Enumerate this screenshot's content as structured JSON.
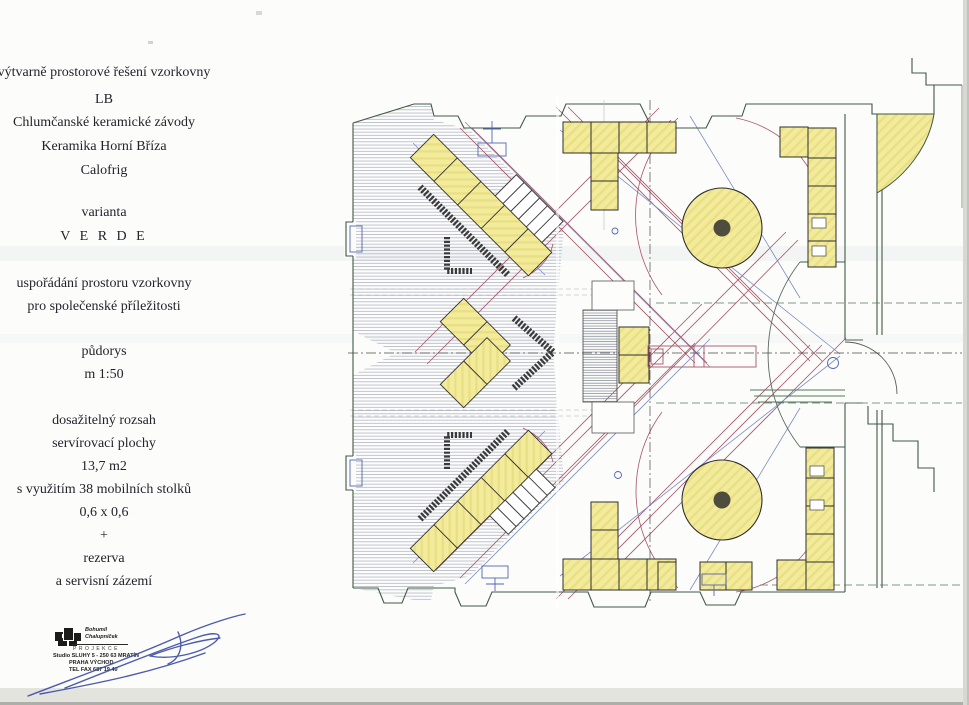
{
  "info_panel": {
    "project_title": "výtvarně prostorové řešení vzorkovny",
    "clients": [
      "LB",
      "Chlumčanské keramické závody",
      "Keramika Horní Bříza",
      "Calofrig"
    ],
    "variant_label": "varianta",
    "variant_name": "V E R D E",
    "purpose": [
      "uspořádání prostoru vzorkovny",
      "pro společenské příležitosti"
    ],
    "drawing_type": "půdorys",
    "scale": "m 1:50",
    "stats": [
      "dosažitelný rozsah",
      "servírovací plochy",
      "13,7 m2",
      "s využitím 38 mobilních stolků",
      "0,6 x 0,6",
      "+",
      "rezerva",
      "a servisní zázemí"
    ]
  },
  "stamp": {
    "studio_name_line1": "Bohumil",
    "studio_name_line2": "Chalupníček",
    "label": "PROJEKCE",
    "address_line1": "Studio SLUHY 5 - 250 63 MRATÍN",
    "address_line2": "PRAHA VÝCHOD",
    "phone": "TEL FAX 687 19 40"
  },
  "plan": {
    "colors": {
      "mobile_table_yellow": "#f2eb9c",
      "reach_line_red": "#a8546a",
      "sightline_blue": "#7b8cc4",
      "perimeter_green": "#3f5a45",
      "display_wall_dark": "#3a3a3a"
    }
  }
}
